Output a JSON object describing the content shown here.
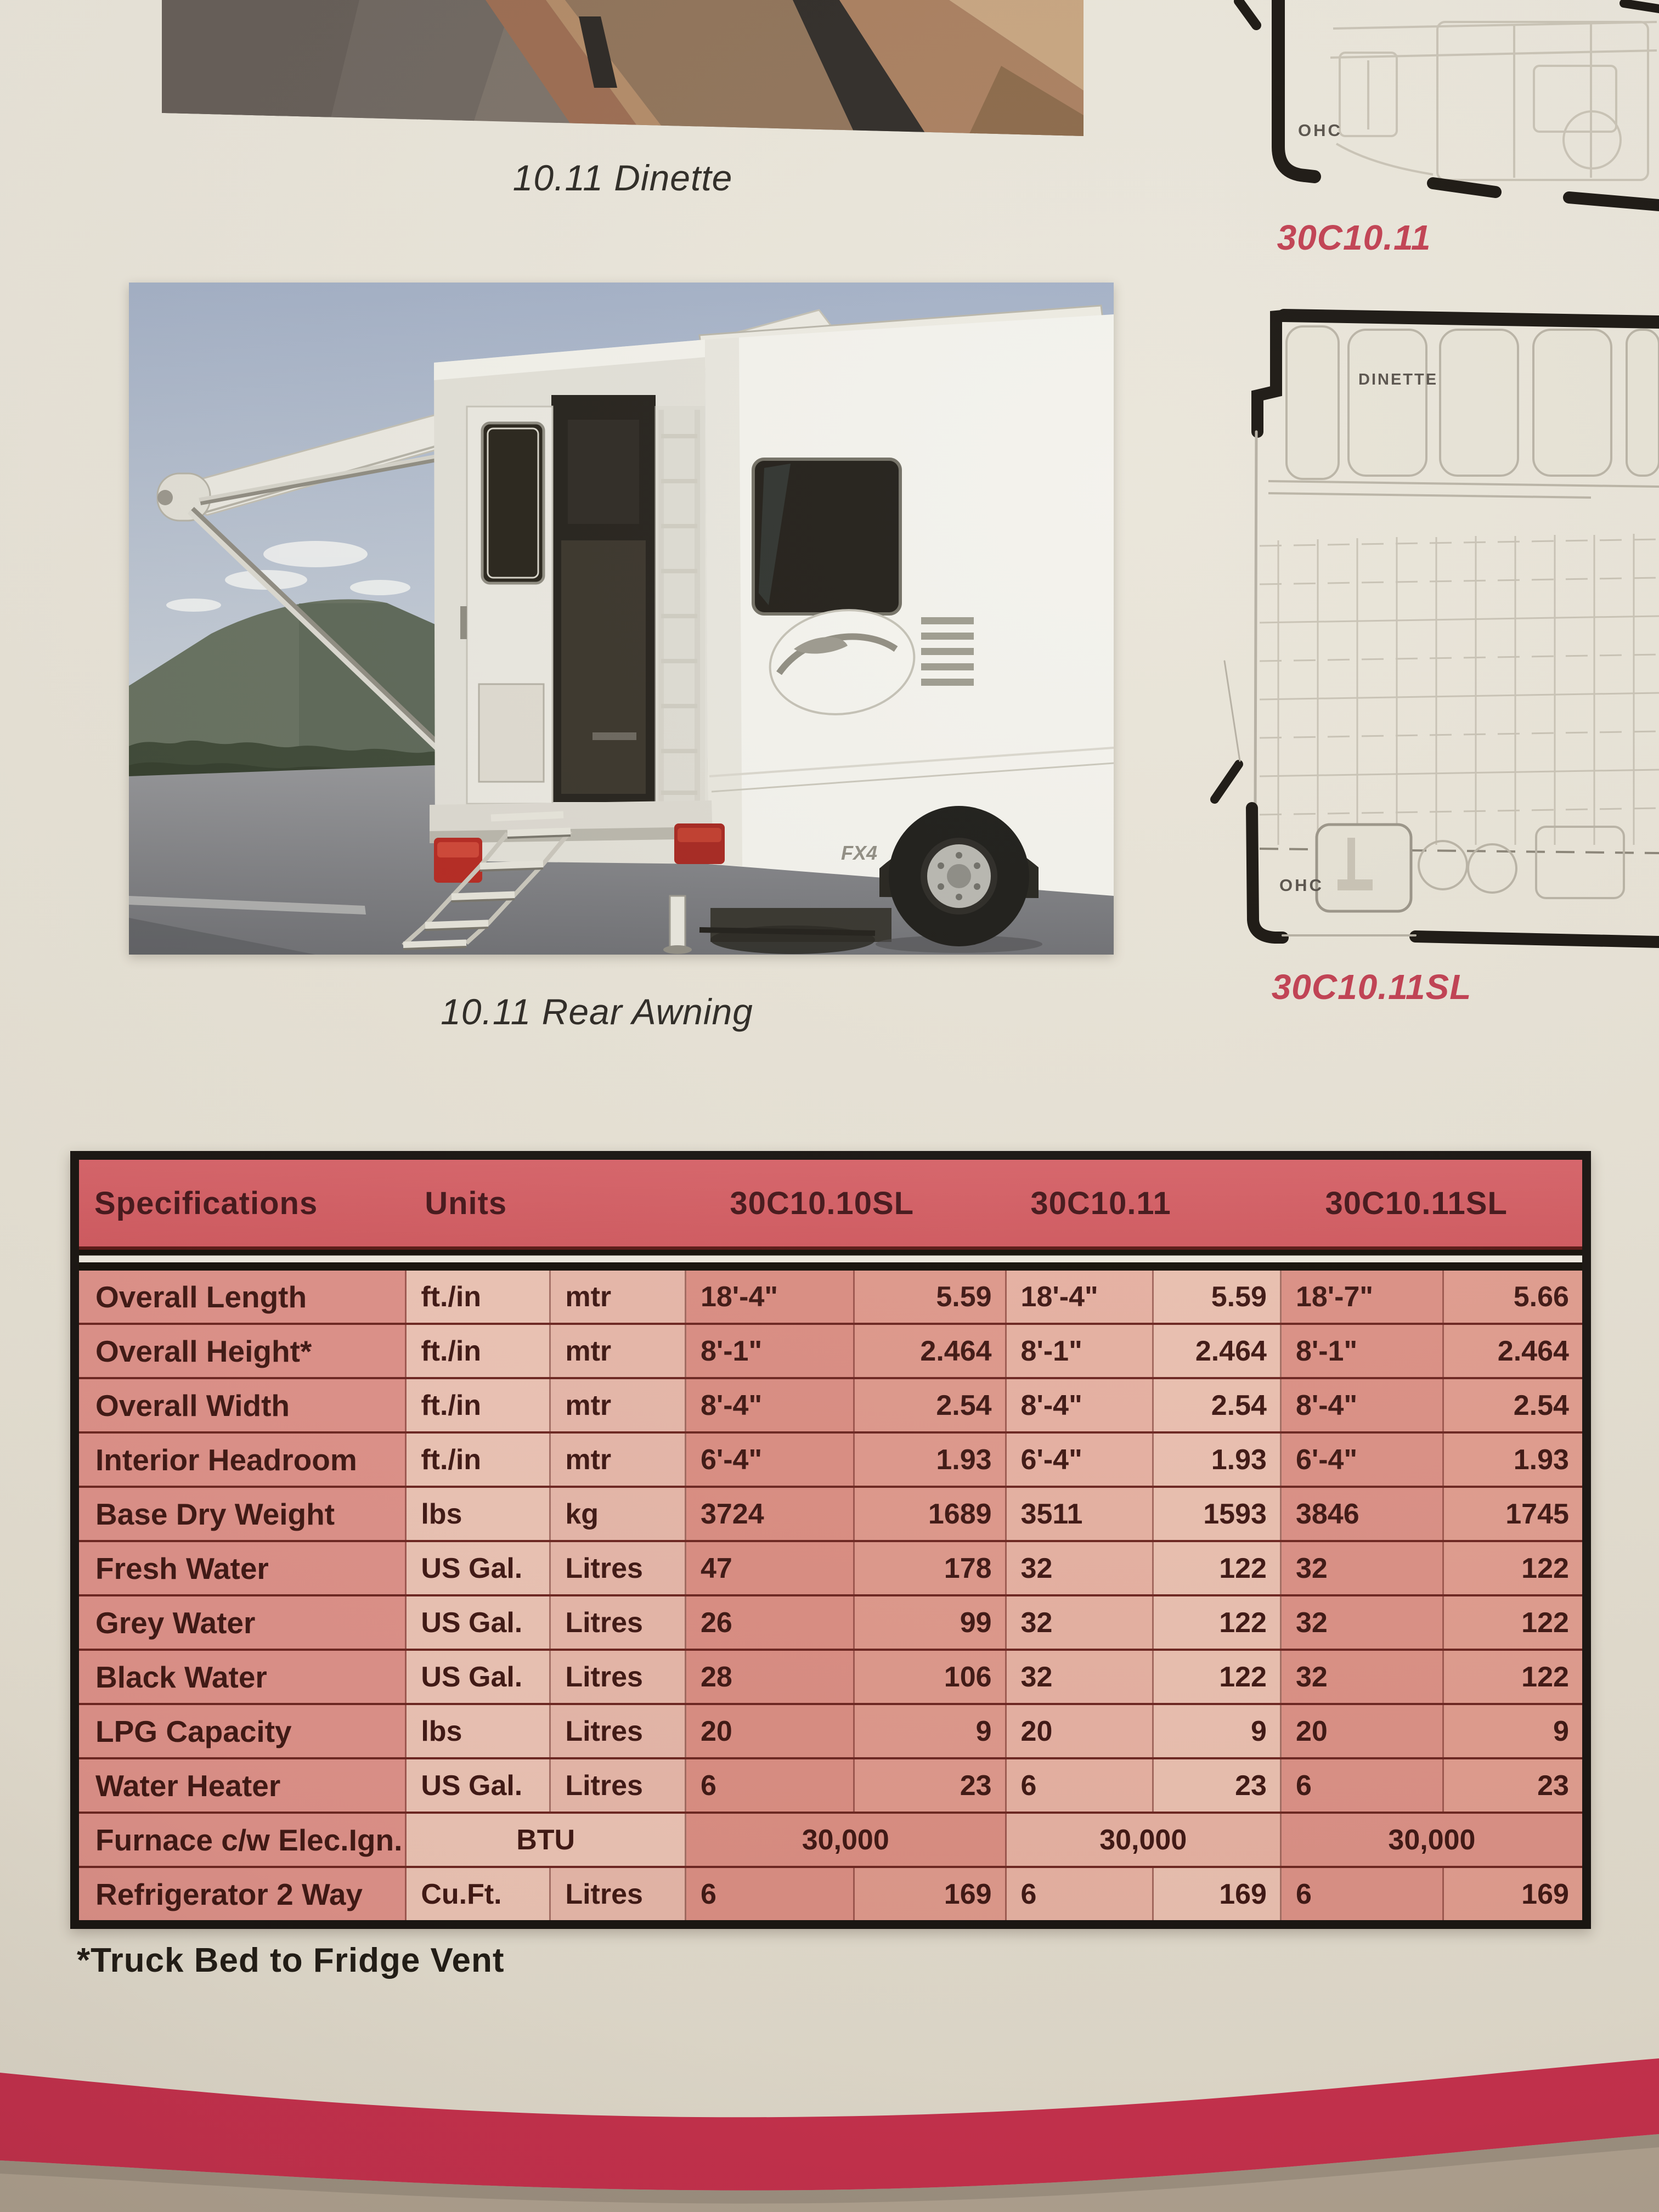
{
  "colors": {
    "page_cream": "#e8e3d6",
    "table_header_red": "#d55e63",
    "table_text_maroon": "#3f1713",
    "caption_red": "#c13e50",
    "bottom_band_red": "#c92f4d",
    "surface_tan": "#b3a593",
    "table_cell_salmon": "#e0928a",
    "table_cell_light_pink": "#eec5b6"
  },
  "top_photo": {
    "caption": "10.11 Dinette"
  },
  "rear_photo": {
    "caption": "10.11 Rear Awning",
    "decal": "FX4"
  },
  "floorplan_top": {
    "label_ohc": "OHC",
    "caption": "30C10.11"
  },
  "floorplan_bottom": {
    "label_dinette": "DINETTE",
    "label_ohc": "OHC",
    "caption": "30C10.11SL"
  },
  "spec_table": {
    "col_specifications": "Specifications",
    "col_units": "Units",
    "models": [
      "30C10.10SL",
      "30C10.11",
      "30C10.11SL"
    ],
    "rows": [
      {
        "label": "Overall Length",
        "unit1": "ft./in",
        "unit2": "mtr",
        "values": [
          "18'-4\"",
          "5.59",
          "18'-4\"",
          "5.59",
          "18'-7\"",
          "5.66"
        ]
      },
      {
        "label": "Overall Height*",
        "unit1": "ft./in",
        "unit2": "mtr",
        "values": [
          "8'-1\"",
          "2.464",
          "8'-1\"",
          "2.464",
          "8'-1\"",
          "2.464"
        ]
      },
      {
        "label": "Overall Width",
        "unit1": "ft./in",
        "unit2": "mtr",
        "values": [
          "8'-4\"",
          "2.54",
          "8'-4\"",
          "2.54",
          "8'-4\"",
          "2.54"
        ]
      },
      {
        "label": "Interior Headroom",
        "unit1": "ft./in",
        "unit2": "mtr",
        "values": [
          "6'-4\"",
          "1.93",
          "6'-4\"",
          "1.93",
          "6'-4\"",
          "1.93"
        ]
      },
      {
        "label": "Base Dry Weight",
        "unit1": "lbs",
        "unit2": "kg",
        "values": [
          "3724",
          "1689",
          "3511",
          "1593",
          "3846",
          "1745"
        ]
      },
      {
        "label": "Fresh Water",
        "unit1": "US Gal.",
        "unit2": "Litres",
        "values": [
          "47",
          "178",
          "32",
          "122",
          "32",
          "122"
        ]
      },
      {
        "label": "Grey Water",
        "unit1": "US Gal.",
        "unit2": "Litres",
        "values": [
          "26",
          "99",
          "32",
          "122",
          "32",
          "122"
        ]
      },
      {
        "label": "Black Water",
        "unit1": "US Gal.",
        "unit2": "Litres",
        "values": [
          "28",
          "106",
          "32",
          "122",
          "32",
          "122"
        ]
      },
      {
        "label": "LPG Capacity",
        "unit1": "lbs",
        "unit2": "Litres",
        "values": [
          "20",
          "9",
          "20",
          "9",
          "20",
          "9"
        ]
      },
      {
        "label": "Water Heater",
        "unit1": "US Gal.",
        "unit2": "Litres",
        "values": [
          "6",
          "23",
          "6",
          "23",
          "6",
          "23"
        ]
      },
      {
        "label": "Furnace c/w Elec.Ign.",
        "unit_span": "BTU",
        "span_values": [
          "30,000",
          "30,000",
          "30,000"
        ]
      },
      {
        "label": "Refrigerator 2 Way",
        "unit1": "Cu.Ft.",
        "unit2": "Litres",
        "values": [
          "6",
          "169",
          "6",
          "169",
          "6",
          "169"
        ]
      }
    ],
    "footnote": "*Truck Bed to Fridge Vent"
  }
}
